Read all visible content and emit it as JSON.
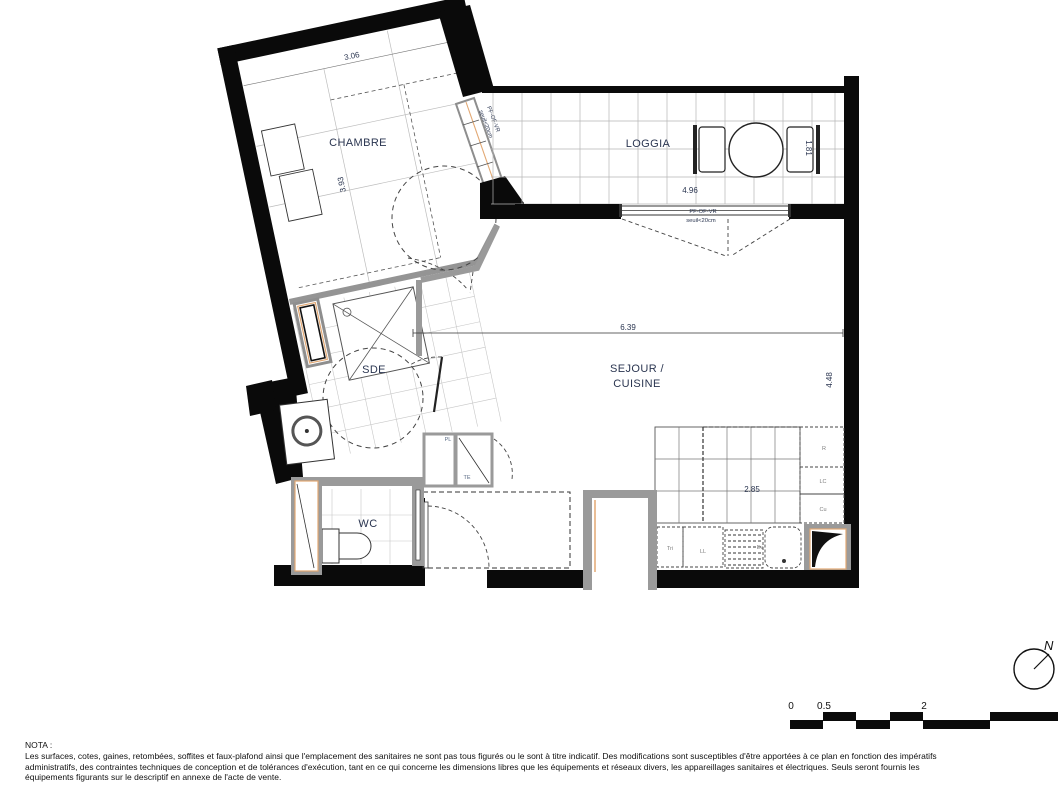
{
  "rooms": {
    "chambre": {
      "label": "CHAMBRE",
      "width": "3.06",
      "depth": "3.93"
    },
    "loggia": {
      "label": "LOGGIA",
      "width": "4.96",
      "depth": "1.81"
    },
    "sejour_cuisine": {
      "label_line1": "SEJOUR /",
      "label_line2": "CUISINE",
      "width": "6.39",
      "depth": "4.48",
      "kitchen_width": "2.85"
    },
    "sde": {
      "label": "SDE"
    },
    "wc": {
      "label": "WC"
    }
  },
  "window": {
    "type": "PF-OF-VR",
    "seuil": "seuil<20cm"
  },
  "equipment": {
    "fridge": "R",
    "laundry_column": "LC",
    "hob": "Cu",
    "sorting": "Tri",
    "washer": "LL",
    "sink": "Ev",
    "closet": "PL",
    "electrical": "TE"
  },
  "scale_bar": {
    "tick0": "0",
    "tick05": "0.5",
    "tick2": "2"
  },
  "north_label": "N",
  "nota": {
    "title": "NOTA :",
    "line1": "Les surfaces, cotes, gaines, retombées, soffites et faux-plafond ainsi que l'emplacement des sanitaires ne sont pas tous figurés ou le sont à titre indicatif. Des modifications sont susceptibles d'être apportées à ce plan en fonction des impératifs",
    "line2": "administratifs, des contraintes techniques de conception et de tolérances d'exécution, tant en ce qui concerne les dimensions libres que les équipements et réseaux divers, les appareillages sanitaires et électriques. Seuls seront fournis les",
    "line3": "équipements figurants sur le descriptif en annexe de l'acte de vente."
  },
  "colors": {
    "wall": "#0a0a0a",
    "secondary_wall": "#9a9a9a",
    "joinery_accent": "#e2a873",
    "label_text": "#2a3550",
    "note_text": "#111111"
  }
}
